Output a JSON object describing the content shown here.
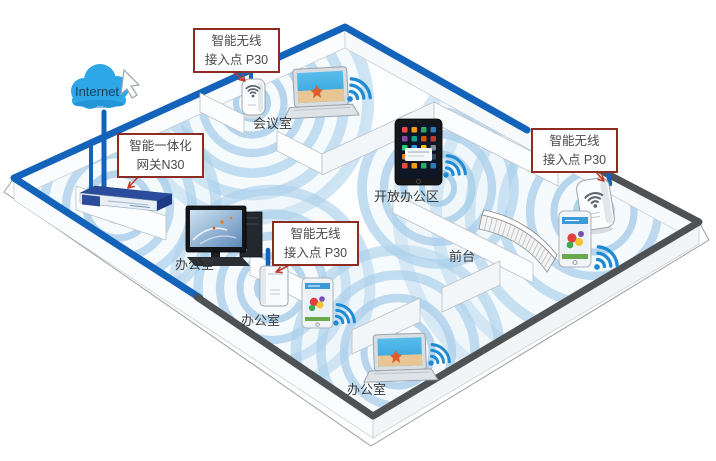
{
  "diagram": {
    "internet_label": "Internet",
    "callouts": {
      "ap_top": {
        "line1": "智能无线",
        "line2": "接入点 P30"
      },
      "gateway": {
        "line1": "智能一体化",
        "line2": "网关N30"
      },
      "ap_right": {
        "line1": "智能无线",
        "line2": "接入点 P30"
      },
      "ap_mid": {
        "line1": "智能无线",
        "line2": "接入点 P30"
      }
    },
    "rooms": {
      "meeting_room": "会议室",
      "open_office": "开放办公区",
      "office_left": "办公室",
      "office_mid": "办公室",
      "office_bottom": "办公室",
      "front_desk": "前台"
    },
    "icons": {
      "wifi": "wifi-signal-icon",
      "cloud": "internet-cloud-icon",
      "cursor": "arrow-cursor-icon"
    },
    "colors": {
      "cable_blue": "#1463bb",
      "dark_wall": "#4e5254",
      "wave_blue": "#a9cfea",
      "wifi_blue": "#1f8bd3",
      "callout_border": "#8e2c21",
      "cloud_blue": "#2ea7e6"
    }
  }
}
